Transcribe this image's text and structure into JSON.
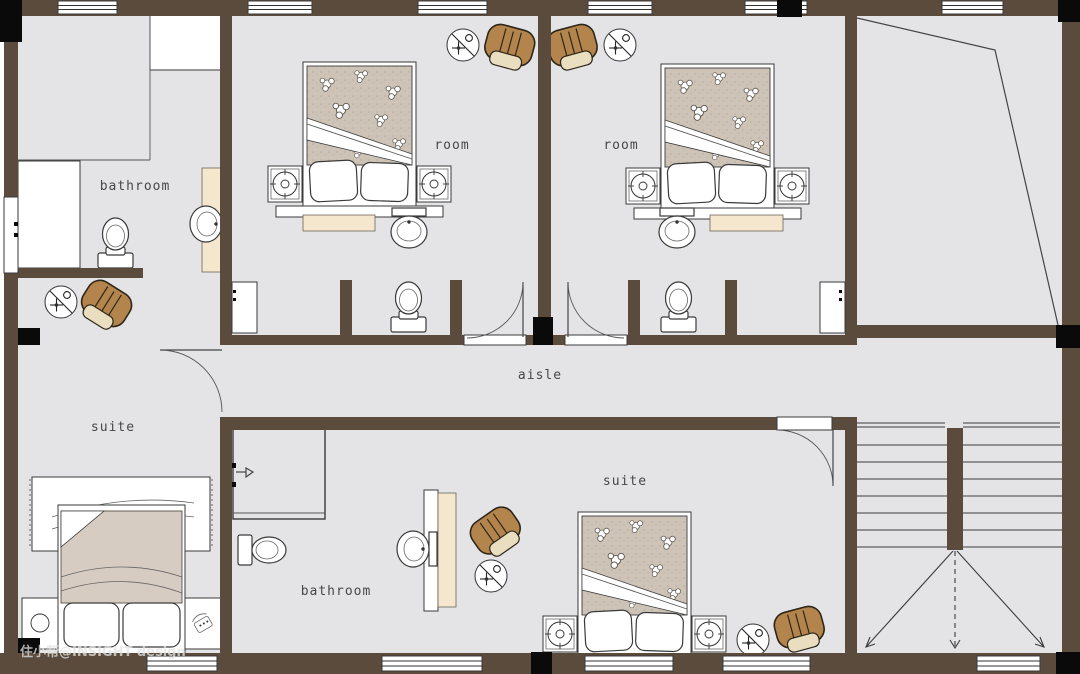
{
  "plan": {
    "labels": {
      "bathroom_top": "bathroom",
      "room_1": "room",
      "room_2": "room",
      "suite_left": "suite",
      "aisle": "aisle",
      "suite_bottom": "suite",
      "bathroom_bottom": "bathroom"
    },
    "watermark": "住小帮@INSIGHT design"
  },
  "colors": {
    "wall": "#5a4b3d",
    "floor": "#e4e4e6",
    "column": "#0a0a0a",
    "line": "#3a3a3a",
    "beige": "#f4e7ce",
    "blanket": "#cec3b7",
    "blanket_plain": "#d7ccc1",
    "armchair": "#b3854d",
    "armchair_seat": "#eadec1",
    "label_text": "#474747",
    "watermark_text": "#e3e3e3"
  },
  "icons": {
    "ceiling_fan": "circle-with-diagonal-fan-symbol",
    "phone": "telephone-on-nightstand",
    "direction_arrows": "stair-direction-arrows"
  }
}
